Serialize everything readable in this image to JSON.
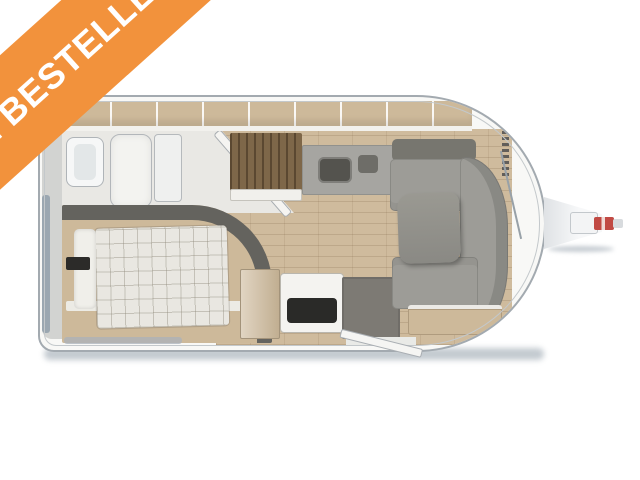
{
  "banner": {
    "label": "TE BESTELLEN"
  },
  "colors": {
    "banner_bg": "#F2923C",
    "banner_fg": "#FFFFFF",
    "outline": "#A3AAB0",
    "wall_fill": "#F8F8F6",
    "wood_floor": "#CFBB9D",
    "cabinet_wood": "#CDB99A",
    "cushion": "#9D9C97",
    "cushion_dark": "#77766F",
    "headboard": "#64635E",
    "duvet": "#E9E7E1",
    "mat": "#7D7A74",
    "hob_black": "#2A2A28",
    "window": "#9BA7B1",
    "hitch_red": "#C14A44",
    "shadow": "#B9C1C8"
  }
}
